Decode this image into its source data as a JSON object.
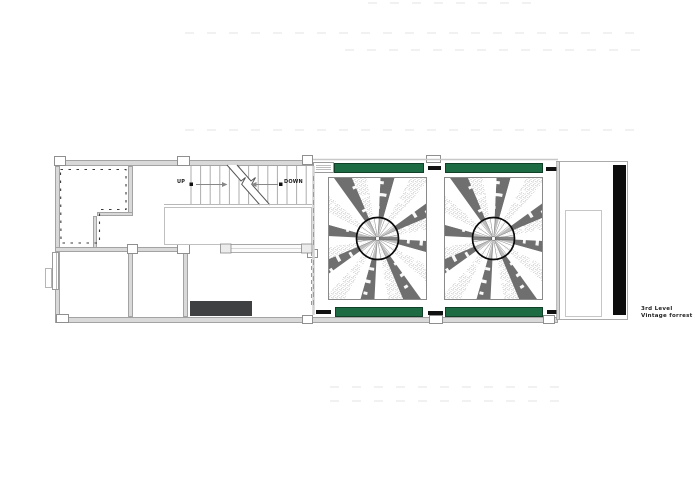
{
  "drawing_title": {
    "line1": "3rd Level",
    "line2": "Vintage forrest"
  },
  "stair": {
    "up_label": "UP",
    "down_label": "DOWN"
  },
  "colors": {
    "green_panel": "#1c6b43",
    "accent_black": "#111111",
    "dark_block": "#3f4042",
    "black_sidebar": "#0d0d0d",
    "wall_fill": "#d9d9d9",
    "wall_edge": "#a3a3a3",
    "ray_dark": "#6f6f6f",
    "ray_speckle": "#8f8f8f",
    "circle_outline": "#0a0a0a"
  }
}
